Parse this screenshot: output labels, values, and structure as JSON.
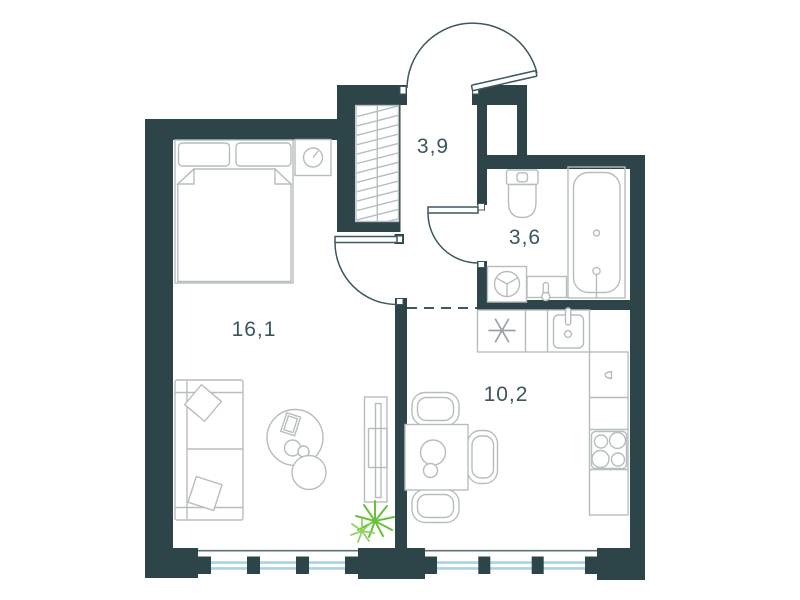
{
  "page": {
    "type": "apartment-floor-plan",
    "description": "1-room apartment plan with living room, hallway, bathroom and kitchen"
  },
  "rooms": [
    {
      "name": "living-room",
      "area_label": "16,1"
    },
    {
      "name": "hallway",
      "area_label": "3,9"
    },
    {
      "name": "bathroom",
      "area_label": "3,6"
    },
    {
      "name": "kitchen",
      "area_label": "10,2"
    }
  ],
  "icons": {
    "wardrobe": "diagonal-hatch-rectangle",
    "hob_unit": "asterisk-symbol",
    "stove": "four-burner-circles",
    "washing_machine": "circle-with-three-spokes",
    "entrance_door": "quarter-arc-swing-out",
    "interior_doors": "quarter-arc-swing-in",
    "windows": "double-blue-line-with-mullions",
    "plant": "green-starburst"
  },
  "colors": {
    "wall": "#2d4449",
    "furniture_outline": "#b6bdbf",
    "fixture_outline": "#9aa4a7",
    "door_stroke": "#3d585e",
    "label_text": "#3a565e",
    "window_glass": "#a9d2e7",
    "window_sill": "#5f7276",
    "plant": "#69c03d",
    "plant_light": "#8fd360",
    "background": "#ffffff"
  }
}
